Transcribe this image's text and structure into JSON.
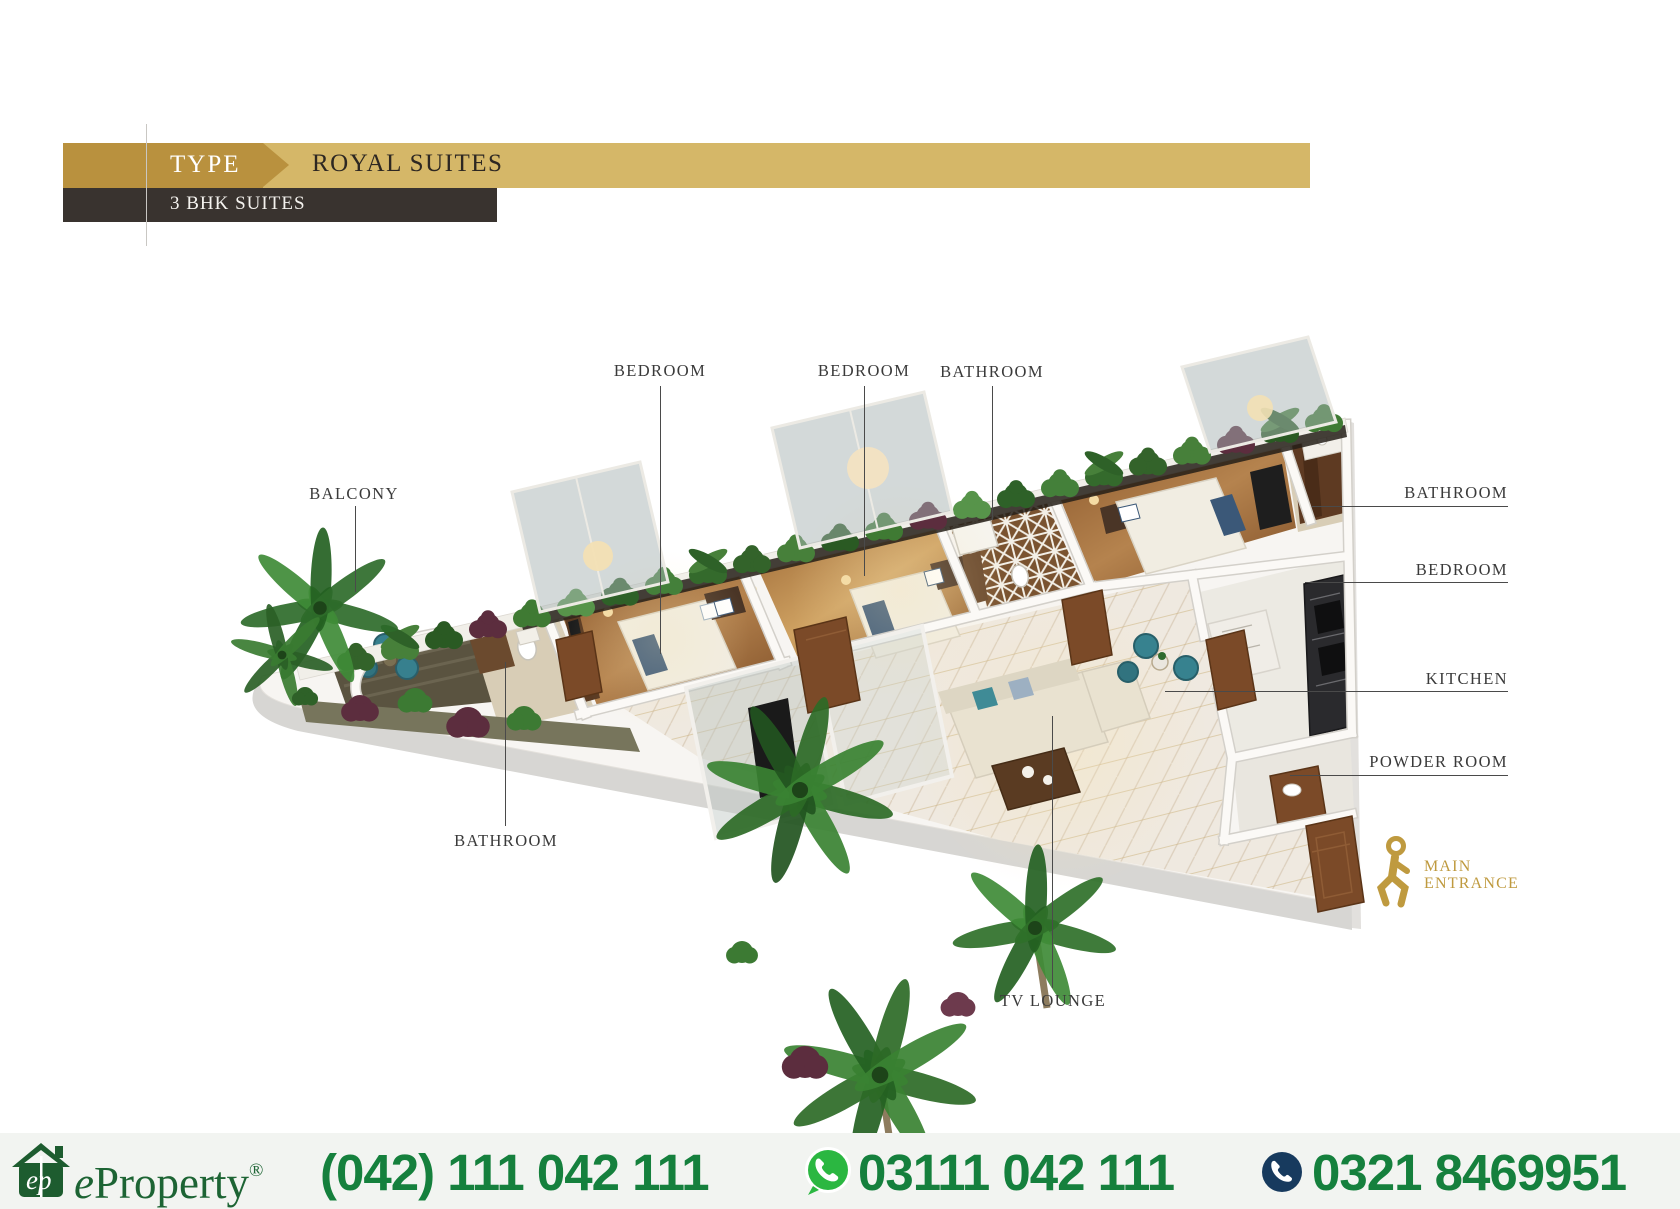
{
  "header": {
    "type_label": "TYPE",
    "title": "ROYAL SUITES",
    "subtitle": "3 BHK SUITES",
    "colors": {
      "gold_dark": "#b9913e",
      "gold_light": "#d5b768",
      "band_dark": "#39332f",
      "title_text": "#2d2722"
    }
  },
  "floorplan": {
    "label_color": "#3a3a3a",
    "labels": {
      "balcony": "BALCONY",
      "bedroom_top_left": "BEDROOM",
      "bedroom_top_mid": "BEDROOM",
      "bathroom_top": "BATHROOM",
      "bathroom_right": "BATHROOM",
      "bedroom_right": "BEDROOM",
      "kitchen": "KITCHEN",
      "powder_room": "POWDER ROOM",
      "bathroom_bottom": "BATHROOM",
      "tv_lounge": "TV LOUNGE"
    },
    "main_entrance": {
      "line1": "MAIN",
      "line2": "ENTRANCE",
      "color": "#bf9a3f"
    }
  },
  "footer": {
    "logo_monogram": "ep",
    "brand_e": "e",
    "brand_rest": "Property",
    "registered": "®",
    "phones": {
      "landline": "(042) 111 042 111",
      "whatsapp": "03111 042 111",
      "mobile": "0321 8469951"
    },
    "colors": {
      "number_green": "#15803d",
      "brand_green": "#1d6434",
      "whatsapp_green": "#2bb741",
      "phone_navy": "#173a5e",
      "background": "#f2f4f1"
    }
  }
}
